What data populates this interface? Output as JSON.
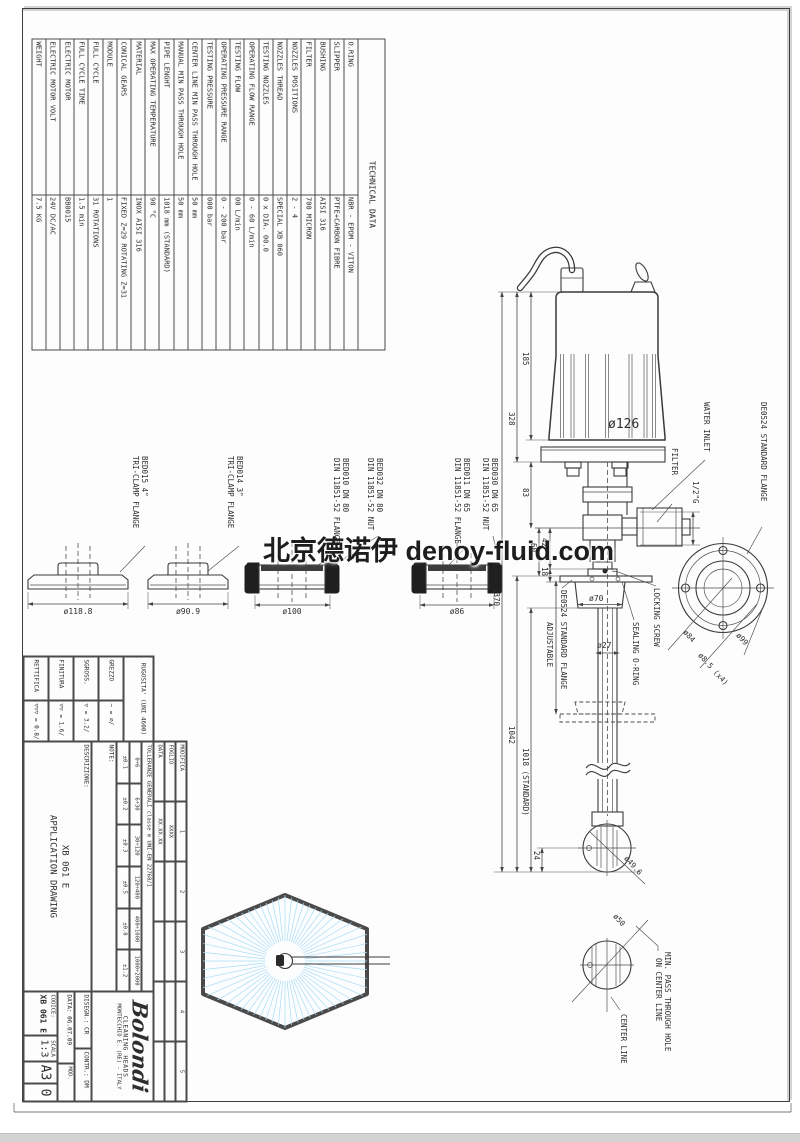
{
  "watermark": "北京德诺伊 denoy-fluid.com",
  "colors": {
    "line": "#3a3a3a",
    "spray_blue": "#aadcf2",
    "sheet": "#fdfdfd",
    "bottom_bar": "#d3d3d3"
  },
  "tech_table": {
    "title": "TECHNICAL DATA",
    "rows": [
      {
        "label": "O.RING",
        "value": "NBR - EPDM - VITON"
      },
      {
        "label": "SLIPPER",
        "value": "PTFE+CARBON FIBRE"
      },
      {
        "label": "BUSHING",
        "value": "AISI 316"
      },
      {
        "label": "FILTER",
        "value": "700 MICRON"
      },
      {
        "label": "NOZZLES POSITIONS",
        "value": "2 - 4"
      },
      {
        "label": "NOZZLES THREAD",
        "value": "SPECIAL XB 060"
      },
      {
        "label": "TESTING NOZZLES",
        "value": "0 x DIA. 00.0"
      },
      {
        "label": "OPERATING FLOW RANGE",
        "value": "0 - 60 L/min"
      },
      {
        "label": "TESTING FLOW",
        "value": "00 L/min"
      },
      {
        "label": "OPERATING PRESSURE RANGE",
        "value": "0 - 200 bar"
      },
      {
        "label": "TESTING PRESSURE",
        "value": "000 bar"
      },
      {
        "label": "CENTER LINE MIN PASS THROUGH HOLE",
        "value": "50 mm"
      },
      {
        "label": "MANUAL MIN PASS THROUGH HOLE",
        "value": "50 mm"
      },
      {
        "label": "PIPE LENGHT",
        "value": "1018 mm (STANDARD)"
      },
      {
        "label": "MAX OPERATING TEMPERATURE",
        "value": "90 °C"
      },
      {
        "label": "MATERIAL",
        "value": "INOX AISI 316"
      },
      {
        "label": "CONICAL GEARS",
        "value": "FIXED Z=29 ROTATING Z=31"
      },
      {
        "label": "MODULE",
        "value": "1"
      },
      {
        "label": "FULL CYCLE",
        "value": "31 ROTATIONS"
      },
      {
        "label": "FULL CYCLE TIME",
        "value": "1.5 min"
      },
      {
        "label": "ELECTRIC MOTOR",
        "value": "BB0015"
      },
      {
        "label": "ELECTRIC MOTOR VOLT",
        "value": "24V DC/AC"
      },
      {
        "label": "WEIGHT",
        "value": "7.5 KG"
      }
    ]
  },
  "flange_views": {
    "triclamp": [
      {
        "code": "BED015 4\"",
        "type": "TRI-CLAMP FLANGE",
        "dia": "ø118.8"
      },
      {
        "code": "BED014 3\"",
        "type": "TRI-CLAMP FLANGE",
        "dia": "ø90.9"
      }
    ],
    "din": [
      {
        "flange": "BED010 DN 80",
        "flange_type": "DIN 11851-52 FLANGE",
        "nut": "BED032 DN 80",
        "nut_type": "DIN 11851-52 NUT",
        "dia": "ø100"
      },
      {
        "flange": "BED011 DN 65",
        "flange_type": "DIN 11851-52 FLANGE",
        "nut": "BED030 DN 65",
        "nut_type": "DIN 11851-52 NUT",
        "dia": "ø86"
      }
    ]
  },
  "pump": {
    "dims": {
      "d185": "185",
      "d328": "328",
      "d83": "83",
      "d60": "60",
      "d42": "42",
      "d18": "18",
      "d1370": "1370",
      "d1042": "1042",
      "d1018": "1018 (STANDARD)",
      "d24": "24",
      "dia126": "ø126",
      "dia70": "ø70",
      "dia27": "ø27",
      "dia49": "ø49.6",
      "inlet_size": "1/2\"G"
    },
    "labels": {
      "water_inlet": "WATER INLET",
      "filter": "FILTER",
      "std_flange": "DE0524 STANDARD FLANGE",
      "locking_screw": "LOCKING SCREW",
      "sealing_oring": "SEALING O-RING",
      "adjustable": "ADJUSTABLE"
    }
  },
  "flange_detail": {
    "title": "DE0524 STANDARD FLANGE",
    "bolt_circle": "ø84",
    "holes": "ø8.5 (x4)",
    "outer": "ø99"
  },
  "min_pass_detail": {
    "dia": "ø50",
    "line1": "MIN. PASS THROUGH HOLE",
    "line2": "ON CENTER LINE",
    "center_line": "CENTER LINE"
  },
  "roughness": {
    "header": "RUGOSITA' (UNI 4600)",
    "rows": [
      {
        "label": "GREZZO",
        "value": "~ = ∅/"
      },
      {
        "label": "SGROSS.",
        "value": "▽ = 3.2/"
      },
      {
        "label": "FINITURA",
        "value": "▽▽ = 1.6/"
      },
      {
        "label": "RETTIFICA",
        "value": "▽▽▽ = 0.8/"
      }
    ]
  },
  "title_block": {
    "modifica": {
      "label": "MODIFICA",
      "cols": [
        "1",
        "2",
        "3",
        "4",
        "5"
      ],
      "foglio": "FOGLIO",
      "foglio_val": "XXXX",
      "data": "DATA",
      "data_val": "XX.XX.XX"
    },
    "tolerances": {
      "header": "TOLLERANZE GENERALI classe m UNI-EN 22768/1",
      "ranges": [
        "0÷6",
        "6÷30",
        "30÷120",
        "120÷400",
        "400÷1000",
        "1000÷2000"
      ],
      "values": [
        "±0.1",
        "±0.2",
        "±0.3",
        "±0.5",
        "±0.8",
        "±1.2"
      ]
    },
    "note_label": "NOTE:",
    "descrizione_label": "DESCRIZIONE:",
    "descrizione_line1": "XB 061 E",
    "descrizione_line2": "APPLICATION DRAWING",
    "company": {
      "logo": "Bolondi",
      "tagline": "CLEANING HEADS",
      "address": "MONTECCHIO E. (RE) - ITALY"
    },
    "disegn": "DISEGN.: CR",
    "contr": "CONTR.: DM",
    "data_field": "DATA: 06.07.09",
    "mod_label": "MOD.",
    "mod_val": "0",
    "scala_label": "SCALA",
    "scala_val": "1:3",
    "format": "A3",
    "codice_label": "CODICE:",
    "codice_val": "XB 061 E"
  }
}
